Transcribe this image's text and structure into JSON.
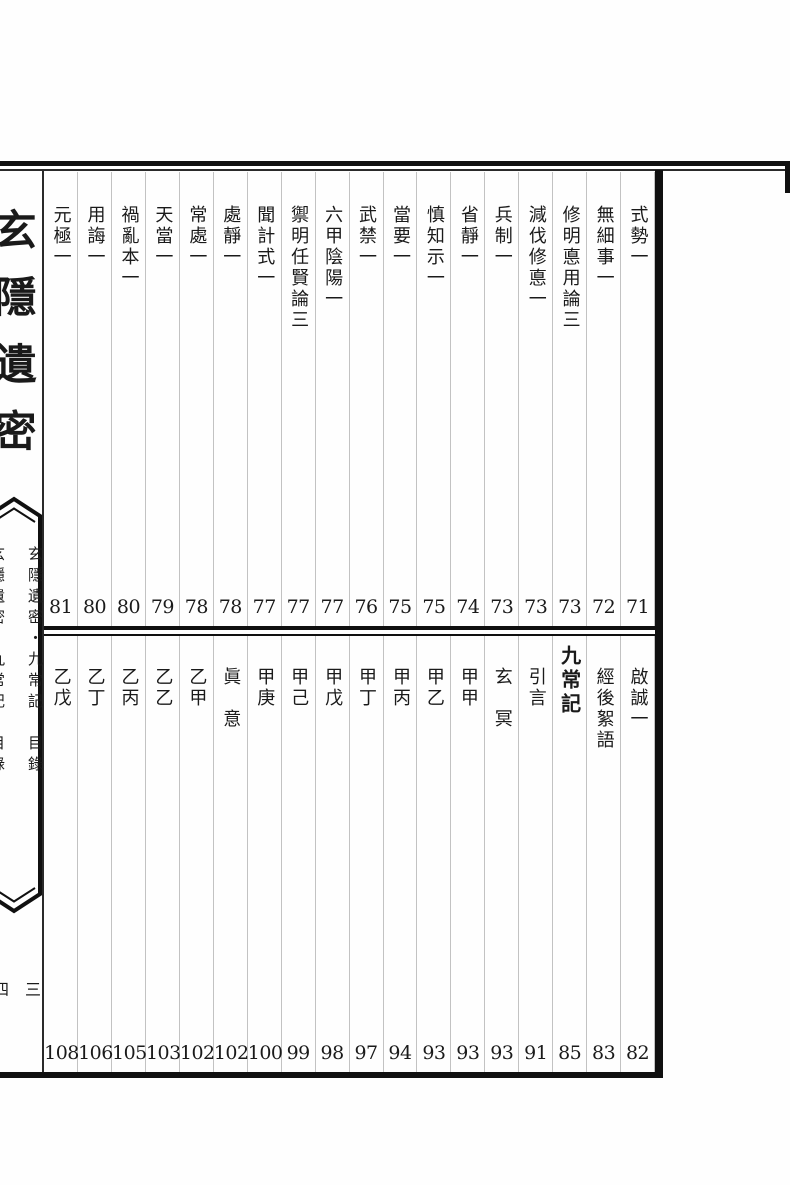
{
  "colors": {
    "background": "#fefefe",
    "text": "#1a1a1a",
    "frame_border": "#101010",
    "column_separator": "#c2c2c2"
  },
  "sidebar": {
    "book_title": "玄隱遺密",
    "spine_label": "玄隱遺密・九常記　目錄",
    "spine_label_secondary": "玄隱遺密・九常記　目錄",
    "folio_right": "三",
    "folio_left": "四"
  },
  "toc": {
    "upper": {
      "entries": [
        {
          "title": "式勢一",
          "page": "71"
        },
        {
          "title": "無細事一",
          "page": "72"
        },
        {
          "title": "修明悳用論三",
          "page": "73"
        },
        {
          "title": "減伐修悳一",
          "page": "73"
        },
        {
          "title": "兵制一",
          "page": "73"
        },
        {
          "title": "省靜一",
          "page": "74"
        },
        {
          "title": "慎知示一",
          "page": "75"
        },
        {
          "title": "當要一",
          "page": "75"
        },
        {
          "title": "武禁一",
          "page": "76"
        },
        {
          "title": "六甲陰陽一",
          "page": "77"
        },
        {
          "title": "禦明任賢論三",
          "page": "77"
        },
        {
          "title": "聞計式一",
          "page": "77"
        },
        {
          "title": "處靜一",
          "page": "78"
        },
        {
          "title": "常處一",
          "page": "78"
        },
        {
          "title": "天當一",
          "page": "79"
        },
        {
          "title": "禍亂本一",
          "page": "80"
        },
        {
          "title": "用誨一",
          "page": "80"
        },
        {
          "title": "元極一",
          "page": "81"
        }
      ]
    },
    "lower": {
      "entries": [
        {
          "title": "啟誠一",
          "page": "82"
        },
        {
          "title": "經後絮語",
          "page": "83"
        },
        {
          "title": "九常記",
          "page": "85",
          "emphasis": true
        },
        {
          "title": "引言",
          "page": "91"
        },
        {
          "title": "玄　冥",
          "page": "93"
        },
        {
          "title": "甲甲",
          "page": "93"
        },
        {
          "title": "甲乙",
          "page": "93"
        },
        {
          "title": "甲丙",
          "page": "94"
        },
        {
          "title": "甲丁",
          "page": "97"
        },
        {
          "title": "甲戊",
          "page": "98"
        },
        {
          "title": "甲己",
          "page": "99"
        },
        {
          "title": "甲庚",
          "page": "100"
        },
        {
          "title": "眞　意",
          "page": "102"
        },
        {
          "title": "乙甲",
          "page": "102"
        },
        {
          "title": "乙乙",
          "page": "103"
        },
        {
          "title": "乙丙",
          "page": "105"
        },
        {
          "title": "乙丁",
          "page": "106"
        },
        {
          "title": "乙戊",
          "page": "108"
        }
      ]
    }
  }
}
